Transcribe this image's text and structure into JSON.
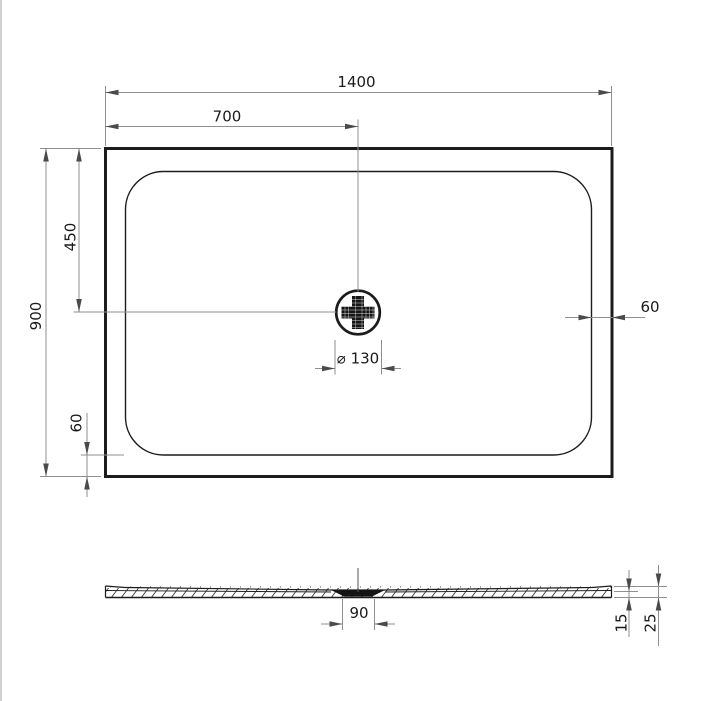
{
  "meta": {
    "type": "technical-drawing",
    "subject": "rectangular shower tray with central round drain, plan view and section view"
  },
  "colors": {
    "background": "#ffffff",
    "outline": "#1c1c1c",
    "dimension_line": "#8f8f8f",
    "arrow": "#4a4a4a",
    "text": "#1a1a1a",
    "drain_fill": "#151515",
    "page_border": "#b4b4b4"
  },
  "top_view": {
    "dimensions": {
      "overall_width": "1400",
      "drain_offset_x": "700",
      "overall_depth": "900",
      "drain_offset_y": "450",
      "rim_margin_right": "60",
      "rim_margin_bottom": "60",
      "drain_diameter": "⌀ 130"
    }
  },
  "section_view": {
    "dimensions": {
      "drain_recess_width": "90",
      "edge_height": "15",
      "total_height": "25"
    }
  }
}
